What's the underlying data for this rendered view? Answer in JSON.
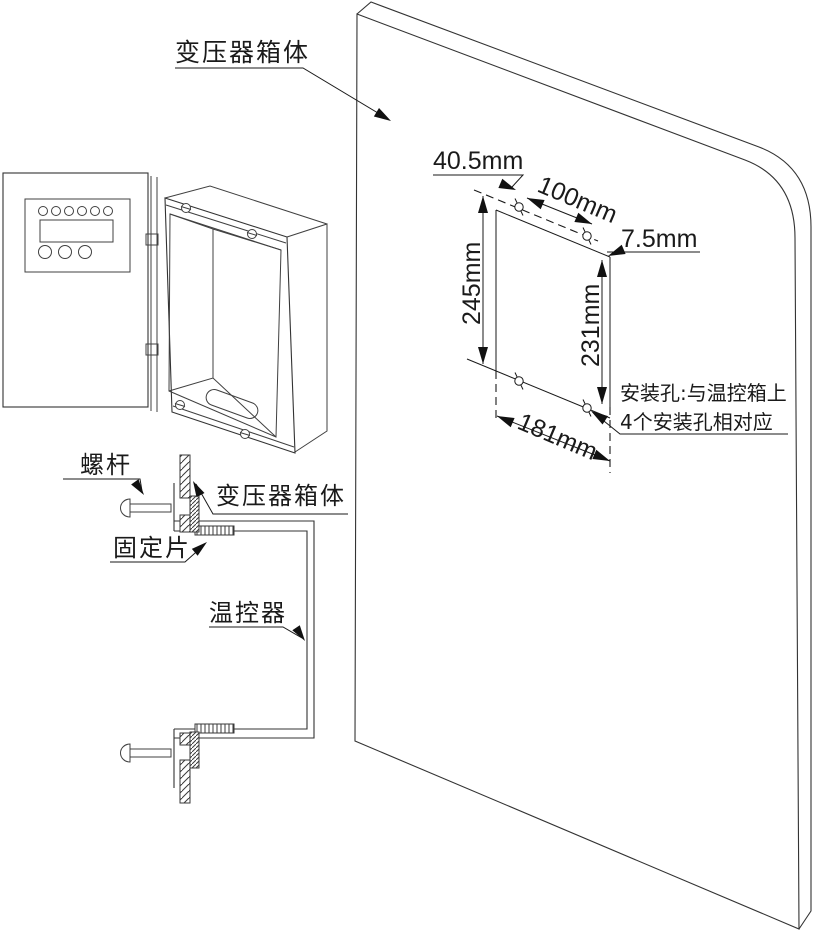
{
  "diagram": {
    "colors": {
      "line": "#404040",
      "ink": "#1a1a1a",
      "background": "#ffffff"
    },
    "panel": {
      "label": "变压器箱体"
    },
    "cutout": {
      "dims": {
        "offset_x": "40.5mm",
        "hole_spacing_x": "100mm",
        "offset_y": "7.5mm",
        "opening_height": "245mm",
        "hole_spacing_y": "231mm",
        "opening_width": "181mm"
      },
      "note": {
        "line1": "安装孔:与温控箱上",
        "line2": "4个安装孔相对应"
      }
    },
    "section": {
      "screw": "螺杆",
      "panel_wall": "变压器箱体",
      "fixing_plate": "固定片",
      "thermostat": "温控器"
    }
  }
}
